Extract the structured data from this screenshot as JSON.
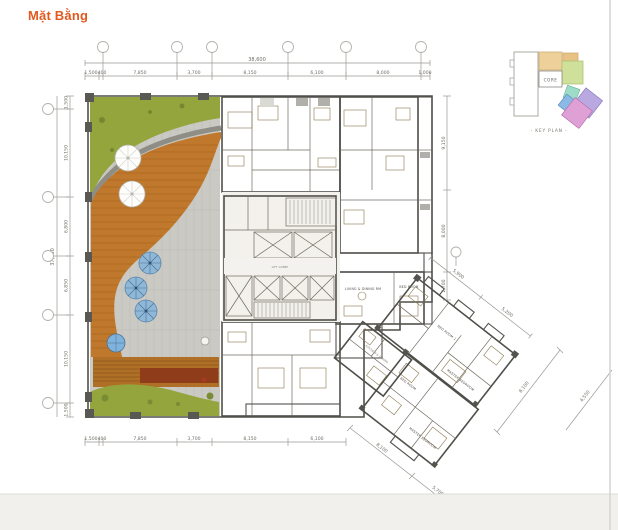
{
  "page": {
    "title": "Mặt Bằng"
  },
  "key_plan": {
    "core_label": "CORE",
    "caption": "-  KEY  PLAN  -"
  },
  "dims": {
    "top_overall": "38,600",
    "top": [
      "1,500",
      "400",
      "7,850",
      "3,700",
      "8,150",
      "6,100",
      "8,000",
      "1,000"
    ],
    "left_overall": "37,000",
    "left": [
      "1,500",
      "10,150",
      "6,800",
      "6,850",
      "10,150",
      "1,500"
    ],
    "right": [
      "9,150",
      "8,000",
      "2,700"
    ],
    "bottom": [
      "1,500",
      "400",
      "7,850",
      "3,700",
      "8,150",
      "6,100"
    ],
    "wing_upper": [
      "5,900",
      "5,200"
    ],
    "wing_lower": [
      "8,100",
      "5,700"
    ],
    "wing_outer": [
      "8,100",
      "4,550"
    ]
  },
  "rooms": {
    "core_lobby": "LIFT LOBBY",
    "mint_living": "LIVING & DINING RM",
    "mint_bed": "BED ROOM",
    "lavender_bed1": "BED ROOM 1",
    "lavender_master": "MASTER BEDROOM",
    "blue_kitchen": "KITCHEN & DINING",
    "pink_bed": "BED ROOM",
    "pink_master": "MASTER BEDROOM"
  },
  "legend_colors": {
    "accent": "#e2581e",
    "lawn": "#94a53e",
    "deck": "#c0792c",
    "paving": "#cac9c3",
    "unit_tan": "#dcc79b",
    "unit_olive": "#c2cd92",
    "unit_mint": "#a8dcb6",
    "unit_lavender": "#b7b1e6",
    "unit_blue": "#85bce8",
    "unit_pink": "#e2a3d8",
    "wall": "#4f4f4a"
  }
}
